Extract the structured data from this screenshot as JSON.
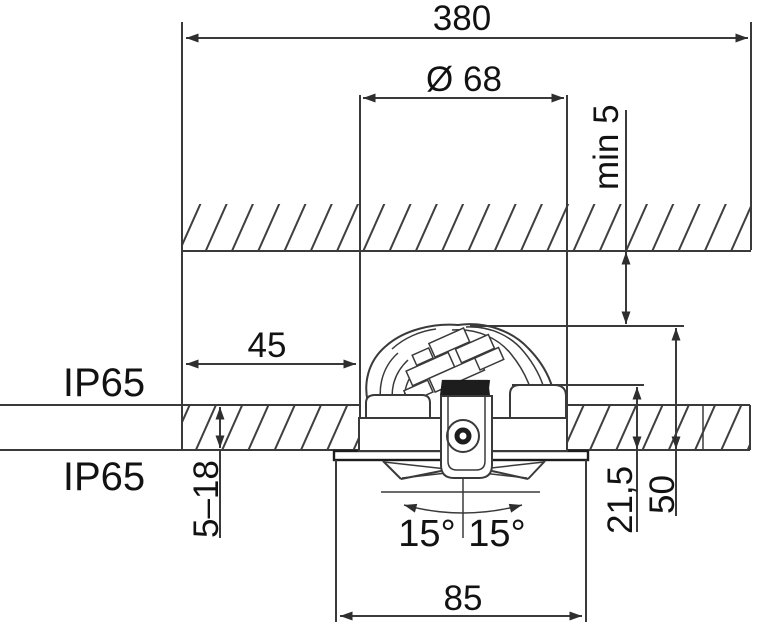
{
  "drawing": {
    "type": "recessed-downlight-installation-dimension-diagram",
    "dimensions": {
      "overall_width": "380",
      "hole_diameter": "Ø 68",
      "min_clearance_above": "min 5",
      "side_clearance": "45",
      "ceiling_thickness_range": "5–18",
      "tilt_angle_left": "15°",
      "tilt_angle_right": "15°",
      "height_above_ceiling_inner": "21,5",
      "height_above_ceiling_total": "50",
      "bezel_width": "85"
    },
    "labels": {
      "ip_rating_upper": "IP65",
      "ip_rating_lower": "IP65"
    },
    "colors": {
      "line": "#3a3a3a",
      "dark_detail": "#1d1d1d",
      "text": "#121212",
      "background": "#ffffff"
    }
  }
}
